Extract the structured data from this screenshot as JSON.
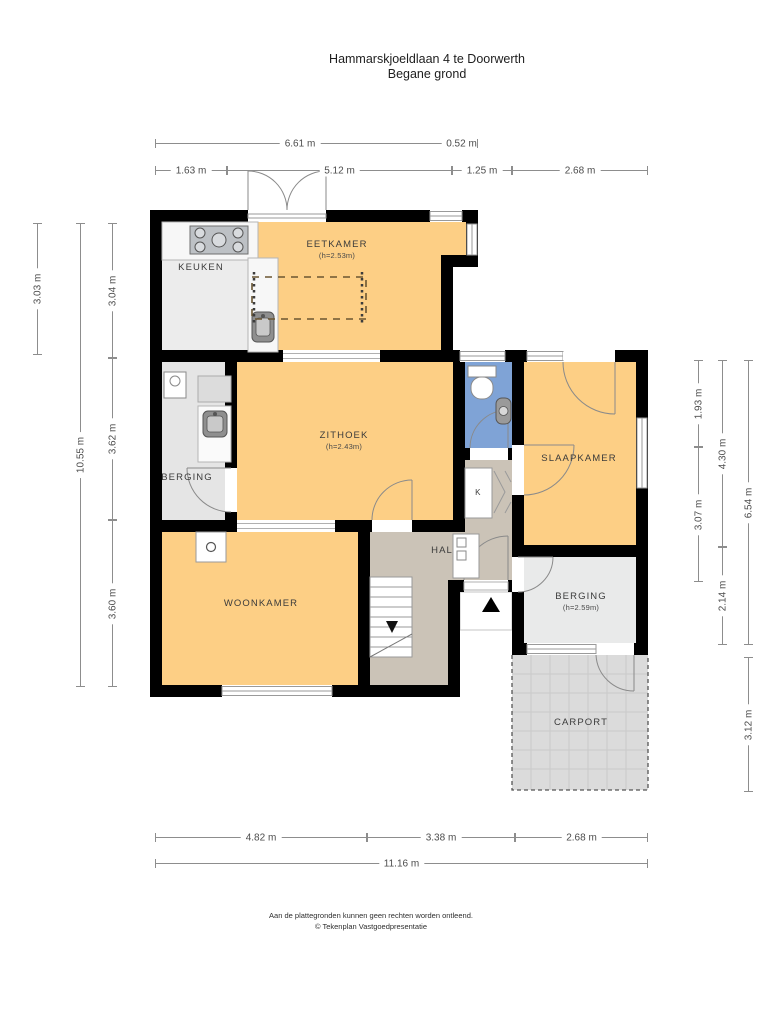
{
  "title": {
    "line1": "Hammarskjoeldlaan 4 te Doorwerth",
    "line2": "Begane grond"
  },
  "rooms": {
    "keuken": {
      "name": "KEUKEN"
    },
    "eetkamer": {
      "name": "EETKAMER",
      "height": "(h=2.53m)"
    },
    "zithoek": {
      "name": "ZITHOEK",
      "height": "(h=2.43m)"
    },
    "berging_left": {
      "name": "BERGING"
    },
    "slaapkamer": {
      "name": "SLAAPKAMER"
    },
    "kast": {
      "name": "K"
    },
    "hal": {
      "name": "HAL"
    },
    "woonkamer": {
      "name": "WOONKAMER"
    },
    "berging_right": {
      "name": "BERGING",
      "height": "(h=2.59m)"
    },
    "carport": {
      "name": "CARPORT"
    }
  },
  "dimensions": {
    "top_row1": [
      {
        "label": "6.61 m"
      },
      {
        "label": "0.52 m"
      }
    ],
    "top_row2": [
      {
        "label": "1.63 m"
      },
      {
        "label": "5.12 m"
      },
      {
        "label": "1.25 m"
      },
      {
        "label": "2.68 m"
      }
    ],
    "left": [
      {
        "label": "3.03 m"
      },
      {
        "label": "10.55 m"
      },
      {
        "label": "3.04 m"
      },
      {
        "label": "3.62 m"
      },
      {
        "label": "3.60 m"
      }
    ],
    "right": [
      {
        "label": "1.93 m"
      },
      {
        "label": "3.07 m"
      },
      {
        "label": "4.30 m"
      },
      {
        "label": "2.14 m"
      },
      {
        "label": "6.54 m"
      },
      {
        "label": "3.12 m"
      }
    ],
    "bottom_row1": [
      {
        "label": "4.82 m"
      },
      {
        "label": "3.38 m"
      },
      {
        "label": "2.68 m"
      }
    ],
    "bottom_row2": [
      {
        "label": "11.16 m"
      }
    ]
  },
  "footer": {
    "line1": "Aan de plattegronden kunnen geen rechten worden ontleend.",
    "line2": "© Tekenplan Vastgoedpresentatie"
  },
  "colors": {
    "wall": "#000000",
    "floor_orange": "#FDCF85",
    "keuken_gray": "#ECECEC",
    "berging_gray": "#E5E5E5",
    "hal_tan": "#CBC3B7",
    "toilet_blue": "#7FA3D6",
    "carport_gray": "#DBDBDB"
  }
}
